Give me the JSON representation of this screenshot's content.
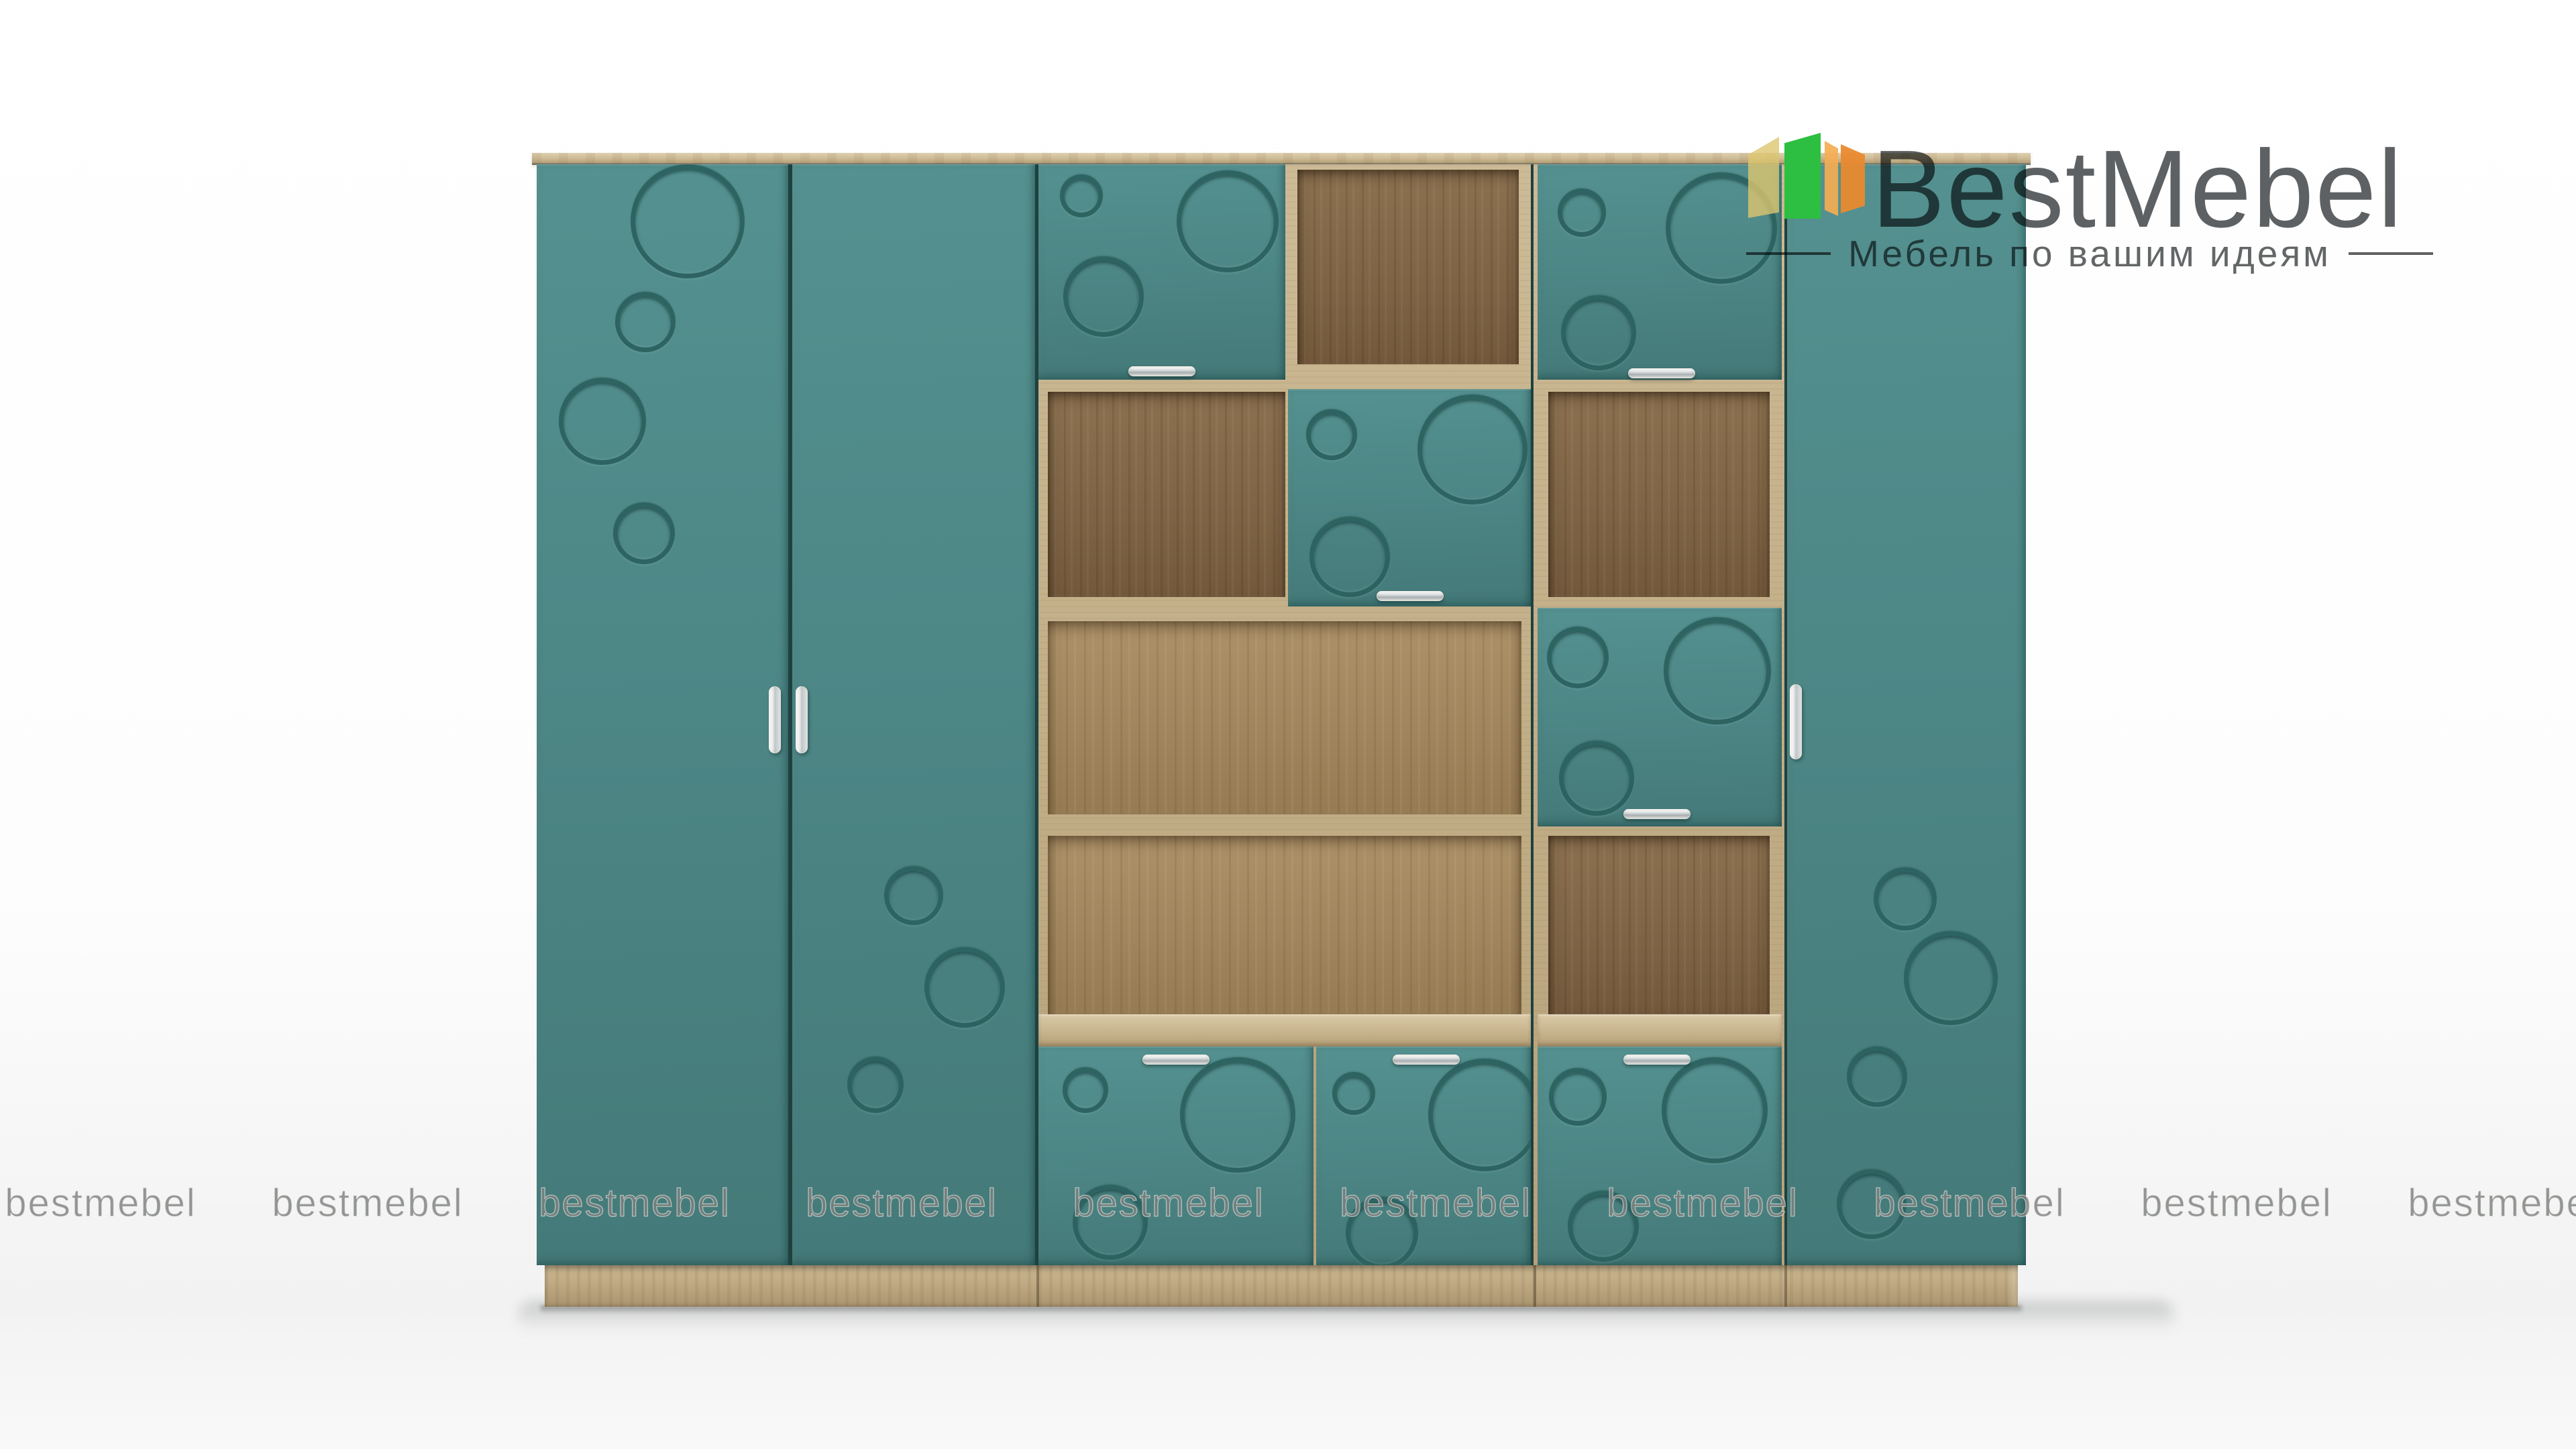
{
  "brand": {
    "title": "BestMebel",
    "subtitle": "Мебель по вашим идеям",
    "title_color": "#55585a",
    "subtitle_color": "#67696a",
    "logo_bar_colors": {
      "pale_yellow": "#dcc66f",
      "green": "#2dbf41",
      "light_orange": "#f4ad52",
      "orange": "#e98a2f"
    }
  },
  "watermark": {
    "text": "bestmebel",
    "count": 10,
    "color": "#8f9290"
  },
  "product_colors": {
    "facade_teal": "#4b8584",
    "decor_ring_teal": "#38706f",
    "oak_cornice": "#cfc0a0",
    "oak_frame": "#c6b38d",
    "oak_interior_dark": "#84694b",
    "oak_interior_light": "#a68c65",
    "oak_plinth": "#c2ae88",
    "handle_chrome": "#e9eced"
  }
}
